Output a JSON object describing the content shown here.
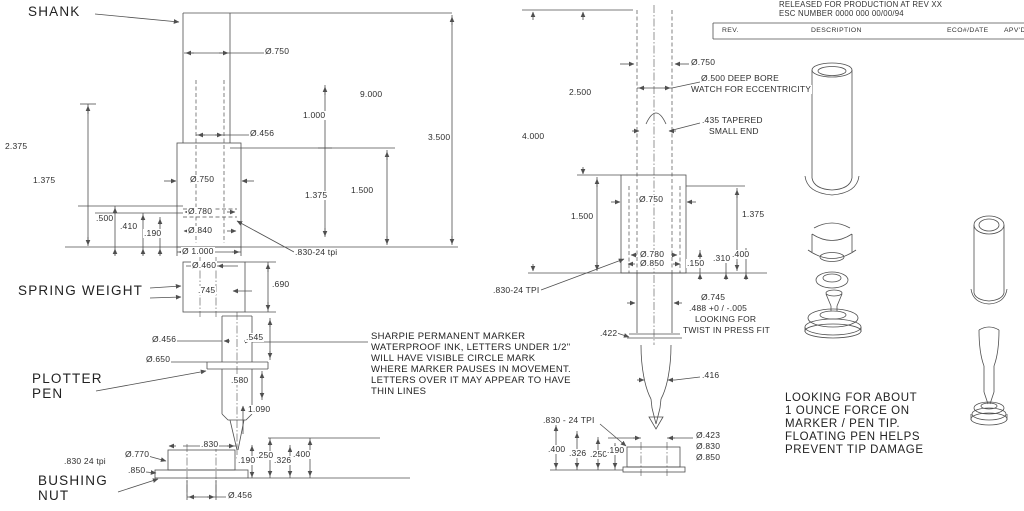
{
  "part_labels": {
    "shank": "SHANK",
    "spring_weight": "SPRING WEIGHT",
    "plotter_1": "PLOTTER",
    "plotter_2": "PEN",
    "bushing_1": "BUSHING",
    "bushing_2": "NUT"
  },
  "left_view": {
    "d750_top": "Ø.750",
    "d456_top": "Ø.456",
    "dim_9000": "9.000",
    "dim_1000": "1.000",
    "dim_3500": "3.500",
    "dim_2375": "2.375",
    "dim_1375_left": "1.375",
    "d750_mid": "Ø.750",
    "dim_1375_right": "1.375",
    "dim_1500": "1.500",
    "dim_500": ".500",
    "dim_410": ".410",
    "dim_190": ".190",
    "d780": "Ø.780",
    "d840": "Ø.840",
    "d1000": "Ø 1.000",
    "thread_830": ".830-24 tpi",
    "d460": "Ø.460",
    "dim_745": ".745",
    "dim_690": ".690",
    "d456_pen": "Ø.456",
    "dim_545": ".545",
    "d650": "Ø.650",
    "dim_580": ".580",
    "dim_1090": "1.090",
    "bn_dim_830": ".830",
    "bn_d770": "Ø.770",
    "bn_thread_830": ".830 24 tpi",
    "bn_dim_850": ".850",
    "bn_dim_190": ".190",
    "bn_dim_250": ".250",
    "bn_dim_326": ".326",
    "bn_dim_400": ".400",
    "bn_d456": "Ø.456"
  },
  "middle_view": {
    "d750_top": "Ø.750",
    "bore_note_1": "Ø.500 DEEP BORE",
    "bore_note_2": "WATCH FOR ECCENTRICITY",
    "dim_2500": "2.500",
    "dim_4000": "4.000",
    "taper_note_1": ".435 TAPERED",
    "taper_note_2": "SMALL END",
    "d750_mid": "Ø.750",
    "dim_1500": "1.500",
    "dim_1375": "1.375",
    "d780": "Ø.780",
    "d850": "Ø.850",
    "dim_150": ".150",
    "dim_310": ".310",
    "dim_400": ".400",
    "thread_830": ".830-24 TPI",
    "d745": "Ø.745",
    "tol_488": ".488 +0 / -.005",
    "press_note_1": "LOOKING FOR",
    "press_note_2": "TWIST IN PRESS FIT",
    "dim_422": ".422",
    "dim_416": ".416",
    "thread_830_b": ".830 - 24 TPI",
    "dim_400_b": ".400",
    "dim_326_b": ".326",
    "dim_250_b": ".250",
    "dim_190_b": ".190",
    "d423": "Ø.423",
    "d830": "Ø.830",
    "d850_b": "Ø.850"
  },
  "notes": {
    "sharpie": [
      "SHARPIE PERMANENT MARKER",
      "WATERPROOF INK, LETTERS UNDER 1/2\"",
      "WILL HAVE VISIBLE CIRCLE MARK",
      "WHERE MARKER PAUSES IN MOVEMENT.",
      "LETTERS OVER IT MAY APPEAR TO HAVE",
      "THIN LINES"
    ],
    "force": [
      "LOOKING FOR ABOUT",
      "1 OUNCE FORCE ON",
      "MARKER / PEN TIP.",
      "FLOATING PEN HELPS",
      "PREVENT TIP DAMAGE"
    ]
  },
  "title_block": {
    "released_line": "RELEASED FOR PRODUCTION AT REV XX",
    "esc_line": "ESC NUMBER 0000 000  00/00/94",
    "col_rev": "REV.",
    "col_description": "DESCRIPTION",
    "col_eco_date": "ECO#/DATE",
    "col_apvd": "APV'D"
  },
  "colors": {
    "line": "#4f4f4f",
    "text": "#2e2e2e",
    "background": "#ffffff"
  }
}
